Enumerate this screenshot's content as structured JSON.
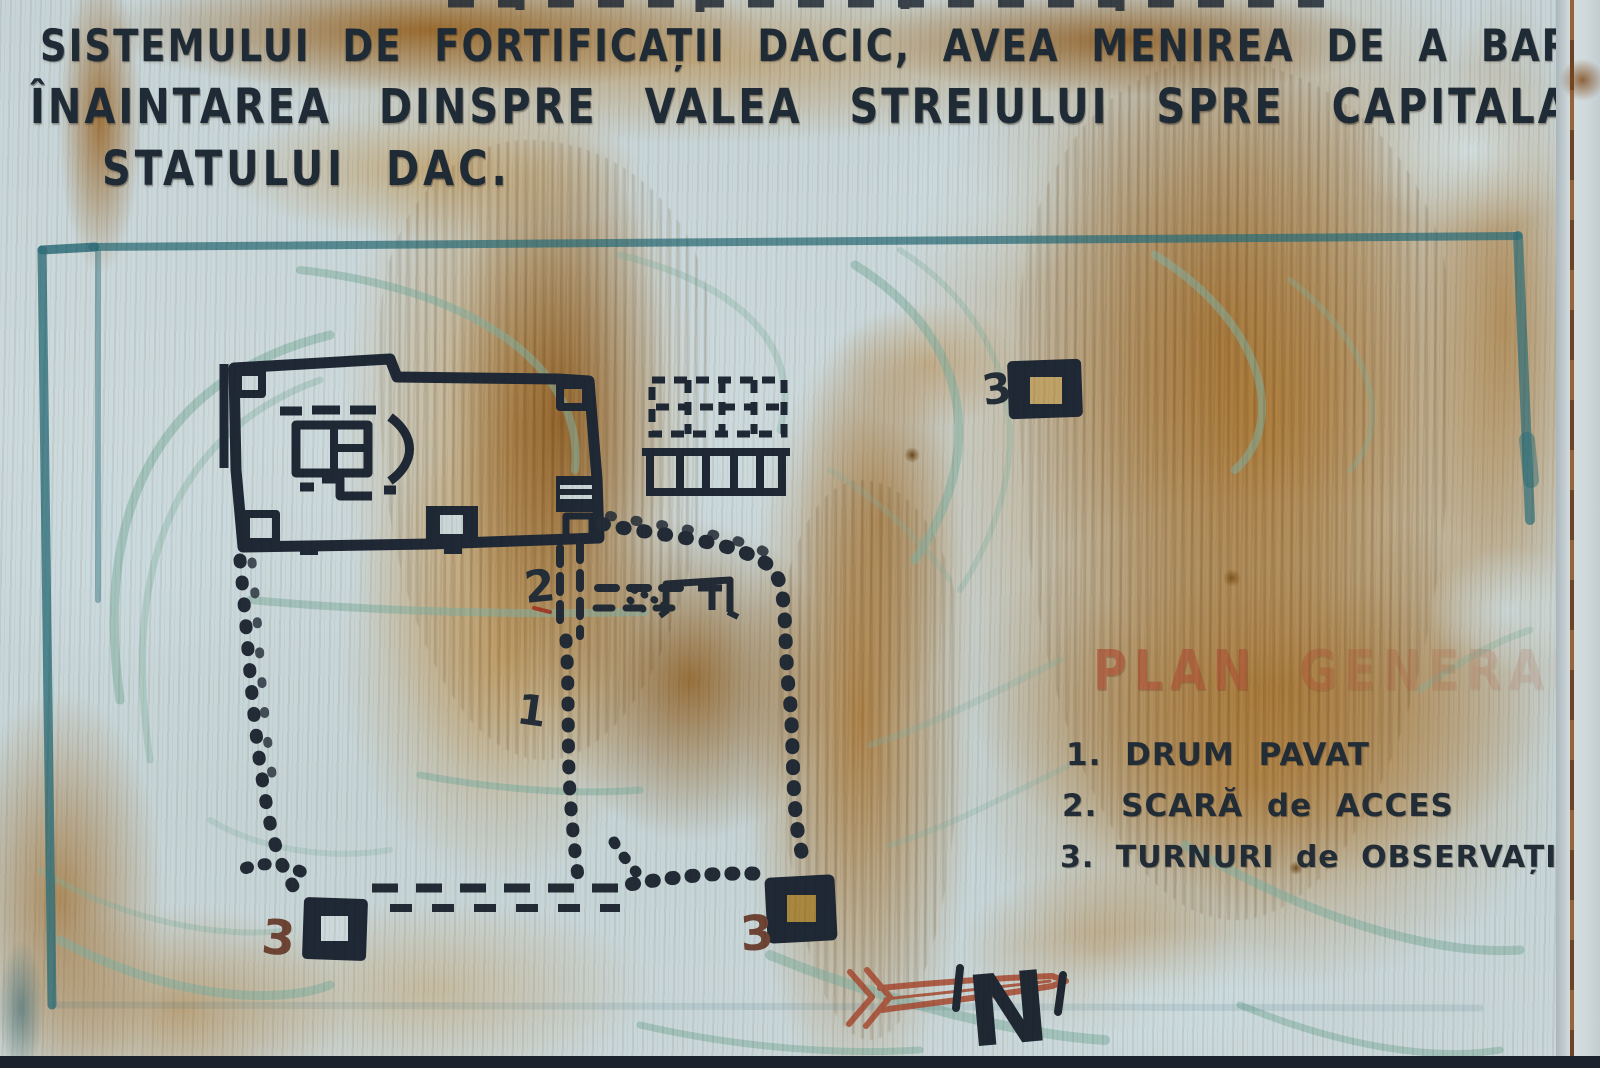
{
  "intro": {
    "line1": "SISTEMULUI DE FORTIFICAȚII DACIC, AVEA MENIREA DE A BARA",
    "line2": "ÎNAINTAREA DINSPRE VALEA STREIULUI SPRE CAPITALA",
    "line3": "STATULUI DAC."
  },
  "legend": {
    "title": "PLAN GENERAL",
    "items": [
      {
        "num": "1.",
        "label": "DRUM PAVAT"
      },
      {
        "num": "2.",
        "label": "SCARĂ de ACCES"
      },
      {
        "num": "3.",
        "label": "TURNURI de OBSERVAȚIE"
      }
    ]
  },
  "map": {
    "labels": {
      "tower_top_right": "3",
      "stairs": "2",
      "paved_road": "1",
      "tower_bottom_left": "3",
      "tower_bottom_center": "3"
    },
    "compass_letter": "N"
  },
  "colors": {
    "panel": "#c9d7da",
    "ink": "#1f2835",
    "rust": "#b97b24",
    "teal_border": "#2f6f7a",
    "contour": "#82b0a0",
    "legend_title": "#ad4f35",
    "arrow_red": "#a85038"
  }
}
